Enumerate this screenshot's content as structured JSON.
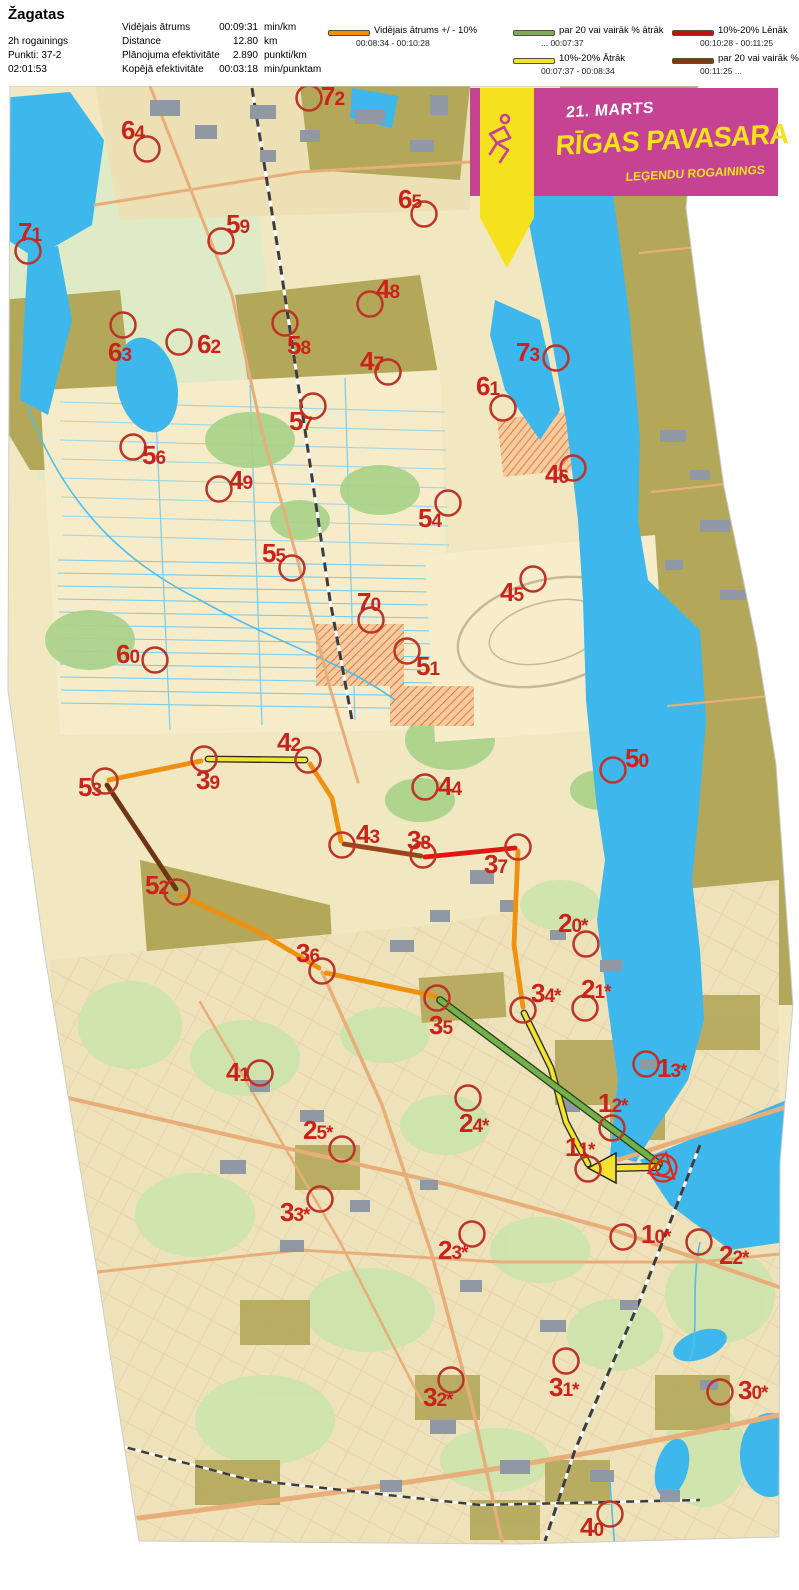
{
  "header": {
    "title": "Žagatas",
    "left_lines": [
      "2h rogainings",
      "Punkti: 37-2",
      "02:01:53"
    ],
    "stats": [
      {
        "label": "Vidējais ātrums",
        "value": "00:09:31",
        "unit": "min/km"
      },
      {
        "label": "Distance",
        "value": "12.80",
        "unit": "km"
      },
      {
        "label": "Plānojuma efektivitāte",
        "value": "2.890",
        "unit": "punkti/km"
      },
      {
        "label": "Kopējā efektivitāte",
        "value": "00:03:18",
        "unit": "min/punktam"
      }
    ]
  },
  "legend": {
    "items": [
      {
        "color": "#EE9110",
        "label": "Vidējais ātrums +/ - 10%",
        "range": "00:08:34   -   00:10:28"
      },
      {
        "color": "#7FA95B",
        "label": "par 20 vai vairāk % ātrāk",
        "range": "...   00:07:37"
      },
      {
        "color": "#F2E32E",
        "label": "10%-20% Ātrāk",
        "range": "00:07:37   -   00:08:34"
      },
      {
        "color": "#C01414",
        "label": "10%-20% Lēnāk",
        "range": "00:10:28   -   00:11:25"
      },
      {
        "color": "#7B3A10",
        "label": "par 20 vai vairāk % lēnāk",
        "range": "00:11:25   ..."
      }
    ]
  },
  "banner": {
    "date": "21. MARTS",
    "title": "RĪGAS PAVASARA",
    "subtitle": "LEĢENDU ROGAININGS",
    "bg_color": "#C54392",
    "accent_color": "#F5E11E"
  },
  "map": {
    "circle_color": "#BC3428",
    "label_color": "#C8241C",
    "controls": [
      {
        "n": "72",
        "x": 309,
        "y": 98,
        "lx": 321,
        "ly": 105
      },
      {
        "n": "64",
        "x": 147,
        "y": 149,
        "lx": 121,
        "ly": 139
      },
      {
        "n": "71",
        "x": 28,
        "y": 251,
        "lx": 18,
        "ly": 241
      },
      {
        "n": "59",
        "x": 221,
        "y": 241,
        "lx": 226,
        "ly": 233
      },
      {
        "n": "65",
        "x": 424,
        "y": 214,
        "lx": 398,
        "ly": 208
      },
      {
        "n": "48",
        "x": 370,
        "y": 304,
        "lx": 376,
        "ly": 298
      },
      {
        "n": "63",
        "x": 123,
        "y": 325,
        "lx": 108,
        "ly": 361
      },
      {
        "n": "62",
        "x": 179,
        "y": 342,
        "lx": 197,
        "ly": 353
      },
      {
        "n": "58",
        "x": 285,
        "y": 323,
        "lx": 287,
        "ly": 354
      },
      {
        "n": "47",
        "x": 388,
        "y": 372,
        "lx": 360,
        "ly": 370
      },
      {
        "n": "73",
        "x": 556,
        "y": 358,
        "lx": 516,
        "ly": 361
      },
      {
        "n": "61",
        "x": 503,
        "y": 408,
        "lx": 476,
        "ly": 395
      },
      {
        "n": "57",
        "x": 313,
        "y": 406,
        "lx": 289,
        "ly": 430
      },
      {
        "n": "56",
        "x": 133,
        "y": 447,
        "lx": 142,
        "ly": 464
      },
      {
        "n": "46",
        "x": 573,
        "y": 468,
        "lx": 545,
        "ly": 483
      },
      {
        "n": "49",
        "x": 219,
        "y": 489,
        "lx": 229,
        "ly": 489
      },
      {
        "n": "54",
        "x": 448,
        "y": 503,
        "lx": 418,
        "ly": 527
      },
      {
        "n": "55",
        "x": 292,
        "y": 568,
        "lx": 262,
        "ly": 562
      },
      {
        "n": "45",
        "x": 533,
        "y": 579,
        "lx": 500,
        "ly": 601
      },
      {
        "n": "70",
        "x": 371,
        "y": 620,
        "lx": 357,
        "ly": 611
      },
      {
        "n": "51",
        "x": 407,
        "y": 651,
        "lx": 416,
        "ly": 675
      },
      {
        "n": "60",
        "x": 155,
        "y": 660,
        "lx": 116,
        "ly": 663
      },
      {
        "n": "50",
        "x": 613,
        "y": 770,
        "lx": 625,
        "ly": 767
      },
      {
        "n": "42",
        "x": 308,
        "y": 760,
        "lx": 277,
        "ly": 751
      },
      {
        "n": "39",
        "x": 204,
        "y": 759,
        "lx": 196,
        "ly": 789
      },
      {
        "n": "53",
        "x": 105,
        "y": 781,
        "lx": 78,
        "ly": 796
      },
      {
        "n": "44",
        "x": 425,
        "y": 787,
        "lx": 438,
        "ly": 795
      },
      {
        "n": "43",
        "x": 342,
        "y": 845,
        "lx": 356,
        "ly": 843
      },
      {
        "n": "38",
        "x": 423,
        "y": 855,
        "lx": 407,
        "ly": 849
      },
      {
        "n": "37",
        "x": 518,
        "y": 847,
        "lx": 484,
        "ly": 873
      },
      {
        "n": "52",
        "x": 177,
        "y": 892,
        "lx": 145,
        "ly": 894
      },
      {
        "n": "36",
        "x": 322,
        "y": 971,
        "lx": 296,
        "ly": 962
      },
      {
        "n": "20*",
        "x": 586,
        "y": 944,
        "lx": 558,
        "ly": 932
      },
      {
        "n": "35",
        "x": 437,
        "y": 998,
        "lx": 429,
        "ly": 1034
      },
      {
        "n": "34*",
        "x": 523,
        "y": 1010,
        "lx": 531,
        "ly": 1002
      },
      {
        "n": "21*",
        "x": 585,
        "y": 1008,
        "lx": 581,
        "ly": 998
      },
      {
        "n": "41",
        "x": 260,
        "y": 1073,
        "lx": 226,
        "ly": 1081
      },
      {
        "n": "13*",
        "x": 646,
        "y": 1064,
        "lx": 657,
        "ly": 1077
      },
      {
        "n": "12*",
        "x": 612,
        "y": 1128,
        "lx": 598,
        "ly": 1112
      },
      {
        "n": "24*",
        "x": 468,
        "y": 1098,
        "lx": 459,
        "ly": 1132
      },
      {
        "n": "25*",
        "x": 342,
        "y": 1149,
        "lx": 303,
        "ly": 1139
      },
      {
        "n": "11*",
        "x": 588,
        "y": 1169,
        "lx": 565,
        "ly": 1156
      },
      {
        "n": "33*",
        "x": 320,
        "y": 1199,
        "lx": 280,
        "ly": 1221
      },
      {
        "n": "23*",
        "x": 472,
        "y": 1234,
        "lx": 438,
        "ly": 1259
      },
      {
        "n": "10*",
        "x": 623,
        "y": 1237,
        "lx": 641,
        "ly": 1243
      },
      {
        "n": "22*",
        "x": 699,
        "y": 1242,
        "lx": 719,
        "ly": 1264
      },
      {
        "n": "32*",
        "x": 451,
        "y": 1380,
        "lx": 423,
        "ly": 1406
      },
      {
        "n": "31*",
        "x": 566,
        "y": 1361,
        "lx": 549,
        "ly": 1396
      },
      {
        "n": "30*",
        "x": 720,
        "y": 1392,
        "lx": 738,
        "ly": 1399
      },
      {
        "n": "40",
        "x": 610,
        "y": 1514,
        "lx": 580,
        "ly": 1536
      }
    ],
    "start": {
      "x": 663,
      "y": 1168
    },
    "route_legs": [
      {
        "name": "leg-11-34",
        "color": "#F2E32E",
        "outline": "#2b2b1a",
        "width": 4.2,
        "points": [
          [
            588,
            1164
          ],
          [
            566,
            1122
          ],
          [
            551,
            1068
          ],
          [
            524,
            1013
          ]
        ]
      },
      {
        "name": "leg-34-37",
        "color": "#EE9110",
        "width": 4.8,
        "points": [
          [
            523,
            1007
          ],
          [
            514,
            945
          ],
          [
            518,
            851
          ]
        ]
      },
      {
        "name": "leg-37-38",
        "color": "#E51410",
        "width": 4.8,
        "points": [
          [
            515,
            848
          ],
          [
            425,
            857
          ]
        ]
      },
      {
        "name": "leg-38-43",
        "color": "#99471A",
        "width": 4.8,
        "points": [
          [
            421,
            856
          ],
          [
            344,
            844
          ]
        ]
      },
      {
        "name": "leg-43-42",
        "color": "#EE9110",
        "width": 4.8,
        "points": [
          [
            341,
            841
          ],
          [
            332,
            798
          ],
          [
            310,
            764
          ]
        ]
      },
      {
        "name": "leg-42-39",
        "color": "#F2E32E",
        "outline": "#2b2b1a",
        "width": 4.2,
        "points": [
          [
            305,
            760
          ],
          [
            208,
            759
          ]
        ]
      },
      {
        "name": "leg-39-53",
        "color": "#EE9110",
        "width": 4.8,
        "points": [
          [
            201,
            761
          ],
          [
            109,
            780
          ]
        ]
      },
      {
        "name": "leg-53-52",
        "color": "#6F3512",
        "width": 4.8,
        "points": [
          [
            107,
            785
          ],
          [
            176,
            889
          ]
        ]
      },
      {
        "name": "leg-52-36",
        "color": "#EE9110",
        "width": 4.8,
        "points": [
          [
            180,
            895
          ],
          [
            257,
            931
          ],
          [
            319,
            968
          ]
        ]
      },
      {
        "name": "leg-36-35",
        "color": "#EE9110",
        "width": 4.8,
        "points": [
          [
            326,
            973
          ],
          [
            435,
            996
          ]
        ]
      },
      {
        "name": "leg-35-finish",
        "color": "#74B04A",
        "outline": "#23411d",
        "width": 5.2,
        "points": [
          [
            440,
            1000
          ],
          [
            659,
            1164
          ]
        ]
      },
      {
        "name": "leg-start-11",
        "color": "#F2E32E",
        "outline": "#222222",
        "width": 5.5,
        "points": [
          [
            657,
            1167
          ],
          [
            611,
            1168
          ]
        ],
        "arrow_head": [
          [
            588,
            1168
          ],
          [
            616,
            1153
          ],
          [
            616,
            1183
          ]
        ]
      }
    ]
  }
}
